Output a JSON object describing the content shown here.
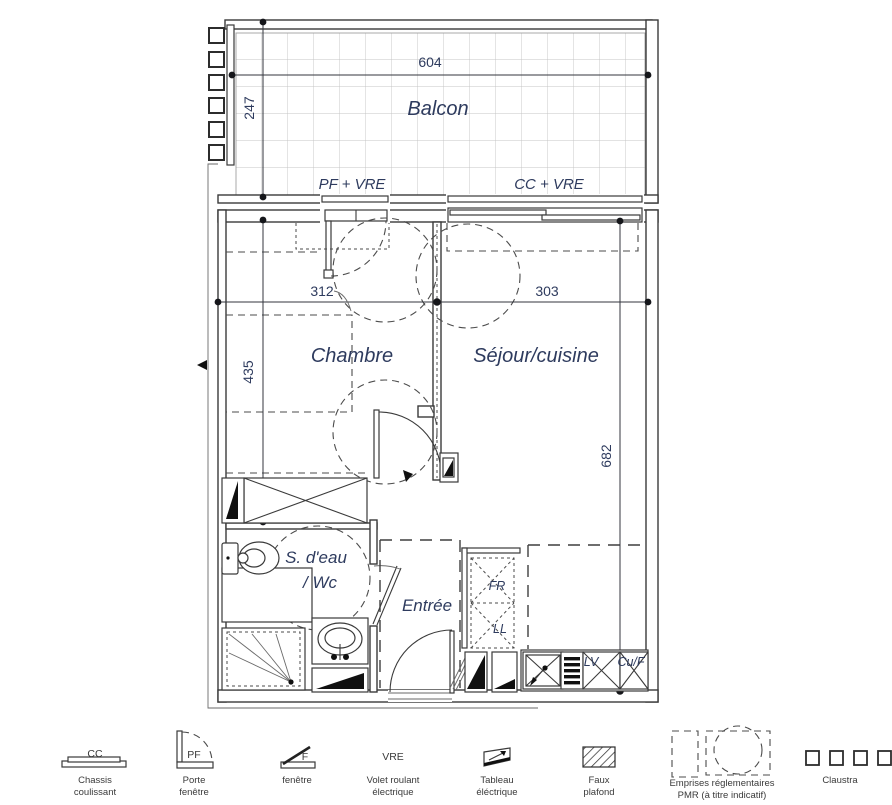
{
  "plan": {
    "balcony": {
      "label": "Balcon",
      "dim_width": "604",
      "dim_depth": "247",
      "window_left_label": "PF + VRE",
      "window_right_label": "CC + VRE"
    },
    "rooms": {
      "chambre": {
        "label": "Chambre",
        "dim_width": "312",
        "dim_height": "435"
      },
      "sejour": {
        "label": "Séjour/cuisine",
        "dim_width": "303",
        "dim_height": "682"
      },
      "bathroom": {
        "label_line1": "S. d'eau",
        "label_line2": "/ Wc"
      },
      "entree": {
        "label": "Entrée"
      }
    },
    "appliances": {
      "fridge": "FR",
      "washer": "LL",
      "dishwasher": "LV",
      "oven": "Cu/F"
    }
  },
  "legend": {
    "items": [
      {
        "code": "CC",
        "caption1": "Chassis",
        "caption2": "coulissant"
      },
      {
        "code": "PF",
        "caption1": "Porte",
        "caption2": "fenêtre"
      },
      {
        "code": "F",
        "caption1": "fenêtre",
        "caption2": ""
      },
      {
        "code": "VRE",
        "caption1": "Volet roulant",
        "caption2": "électrique"
      },
      {
        "code": "",
        "caption1": "Tableau",
        "caption2": "éléctrique"
      },
      {
        "code": "",
        "caption1": "Faux",
        "caption2": "plafond"
      },
      {
        "code": "",
        "caption1": "Emprises réglementaires",
        "caption2": "PMR (à titre indicatif)"
      },
      {
        "code": "",
        "caption1": "Claustra",
        "caption2": ""
      }
    ]
  },
  "colors": {
    "label_navy": "#2e3b5e",
    "line": "#3a3a3a",
    "grid": "#c4c4c4"
  }
}
